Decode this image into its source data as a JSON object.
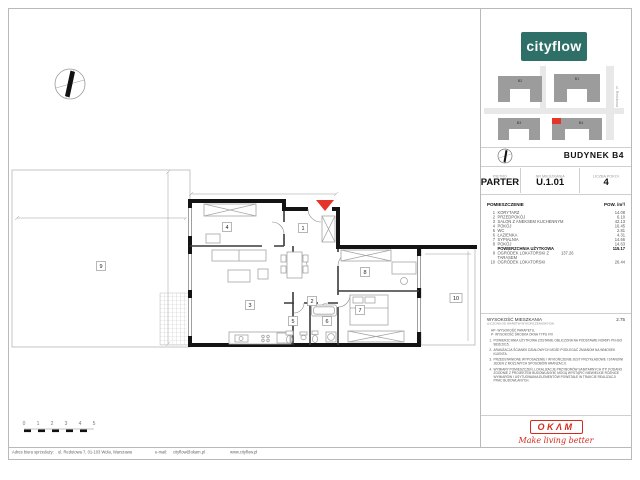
{
  "branding": {
    "logo_text": "cityflow",
    "developer_name": "OKΛM",
    "developer_tagline": "Make living better"
  },
  "colors": {
    "teal": "#2E6F68",
    "red": "#E5352B"
  },
  "site_plan": {
    "buildings": [
      "B2",
      "B1",
      "B3",
      "B4"
    ],
    "street_label": "ul. Redutowa"
  },
  "header": {
    "building_title": "BUDYNEK B4"
  },
  "unit_info": {
    "columns": [
      {
        "label": "PIĘTRO",
        "value": "PARTER"
      },
      {
        "label": "NR MIESZKANIA",
        "value": "U.1.01"
      },
      {
        "label": "LICZBA POKOI",
        "value": "4"
      }
    ]
  },
  "rooms_table": {
    "name_header": "POMIESZCZENIE",
    "area_header": "POW. /m²/",
    "rows": [
      {
        "no": "1",
        "name": "KORYTARZ",
        "area": "14.08"
      },
      {
        "no": "2",
        "name": "PRZEDPOKÓJ",
        "area": "6.10"
      },
      {
        "no": "3",
        "name": "SALON Z ANEKSEM KUCHENNYM",
        "area": "42.13"
      },
      {
        "no": "4",
        "name": "POKÓJ",
        "area": "16.45"
      },
      {
        "no": "5",
        "name": "WC",
        "area": "2.81"
      },
      {
        "no": "6",
        "name": "ŁAZIENKA",
        "area": "4.31"
      },
      {
        "no": "7",
        "name": "SYPIALNIA",
        "area": "14.66"
      },
      {
        "no": "8",
        "name": "POKÓJ",
        "area": "14.63"
      },
      {
        "no": "",
        "name": "POWIERZCHNIA UŻYTKOWA",
        "area": "115.17"
      },
      {
        "no": "9",
        "name": "OGRÓDEK LOKATORSKI Z TARASEM",
        "area": "137.26"
      },
      {
        "no": "10",
        "name": "OGRÓDEK LOKATORSKI",
        "area": "26.44"
      }
    ]
  },
  "notes": {
    "height_label": "WYSOKOŚĆ MIESZKANIA",
    "height_value": "2.75",
    "height_sub": "(LICZONA OD WARSTW WYKOŃCZENIOWYCH)",
    "legend_1": "HP- WYSOKOŚĆ PARAPETU,",
    "legend_2": "P- WYSOKOŚĆ ŚRODKA OKNA TYPU FIX",
    "items": [
      {
        "no": "1.",
        "text": "POWIERZCHNIA UŻYTKOWA ZOSTANIE OBLICZONA NA PODSTAWIE NORMY PN-ISO 9836:2015."
      },
      {
        "no": "2.",
        "text": "ARANŻACJA ŚCIANEK DZIAŁOWYCH MOŻE PODLEGAĆ ZMIANOM NA WNIOSEK KLIENTA."
      },
      {
        "no": "3.",
        "text": "PRZEDSTAWIONE WYPOSAŻENIE I WYKOŃCZENIE JEST PRZYKŁADOWE I STANOWI JEDEN Z MOŻLIWYCH SPOSOBÓW ARANŻACJI."
      },
      {
        "no": "4.",
        "text": "WYMIARY POMIESZCZEŃ, LOKALIZACJĘ PRZYBORÓW SANITARNYCH ITP. PODANO ZGODNIE Z PROJEKTEM BUDOWLANYM. MOGĄ WYSTĄPIĆ NIEWIELKIE RÓŻNICE WYMIARÓW I USYTUOWANIA ELEMENTÓW POWSTAŁE W TRAKCIE REALIZACJI PRAC BUDOWLANYCH."
      }
    ]
  },
  "plan": {
    "room_labels": [
      "1",
      "2",
      "3",
      "4",
      "5",
      "6",
      "7",
      "8",
      "9",
      "10"
    ],
    "scale_ticks": [
      "0",
      "1",
      "2",
      "3",
      "4",
      "5"
    ]
  },
  "footer": {
    "address_label": "Adres biura sprzedaży:",
    "address": "ul. Redutowa 7, 01-103 Wola, Warszawa",
    "email_label": "e-mail:",
    "email": "cityflow@okam.pl",
    "website": "www.cityflow.pl"
  }
}
